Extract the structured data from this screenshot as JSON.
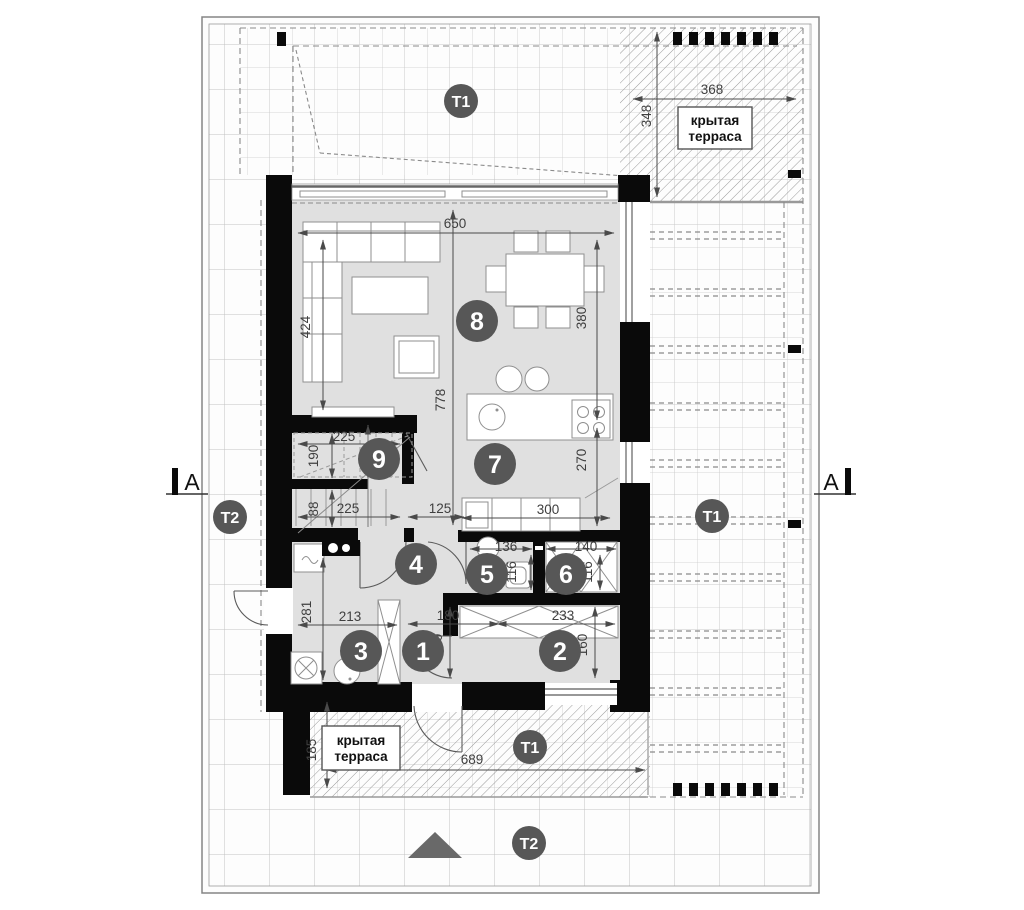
{
  "drawing": {
    "section_marker": "A",
    "terrace_label_line1": "крытая",
    "terrace_label_line2": "терраса",
    "zone_t1": "T1",
    "zone_t2": "T2",
    "room_numbers": [
      "1",
      "2",
      "3",
      "4",
      "5",
      "6",
      "7",
      "8",
      "9"
    ],
    "dimensions_cm": {
      "living_width": "650",
      "living_depth": "424",
      "dining_depth": "380",
      "interior_depth": "778",
      "kitchen_depth": "270",
      "stair_top_width": "225",
      "stair_top_depth": "190",
      "stair_bottom_depth": "88",
      "stair_bottom_width": "225",
      "hall_passage_width": "125",
      "kitchen_counter_width": "300",
      "wc_width": "136",
      "wc_depth": "116",
      "closet_width": "140",
      "closet_depth": "116",
      "utility_depth": "281",
      "utility_width": "213",
      "entry_width": "180",
      "entry_depth": "160",
      "room2_width": "233",
      "room2_depth": "160",
      "terrace_south_depth": "185",
      "terrace_south_width": "689",
      "terrace_east_width": "368",
      "terrace_east_depth": "348"
    },
    "colors": {
      "wall": "#0a0a0a",
      "floor": "#e0e0e0",
      "badge": "#575757",
      "dimension_text": "#3f3f3f",
      "grid_line": "#bdbdbd",
      "hatch_line": "#9a9a9a"
    }
  }
}
